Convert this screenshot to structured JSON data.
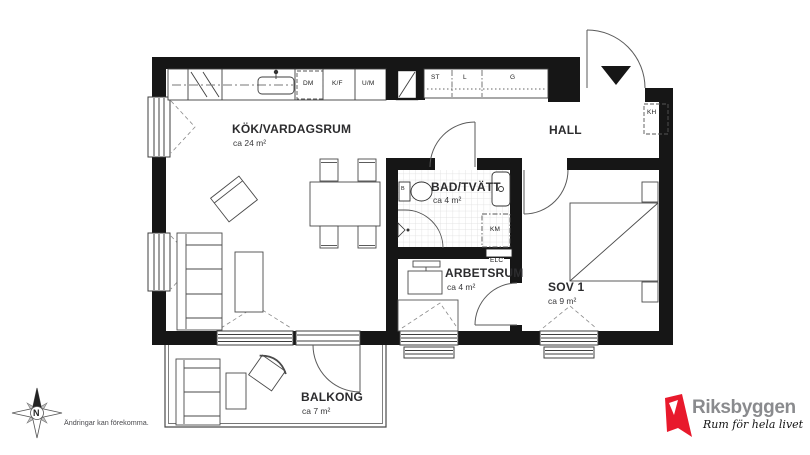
{
  "rooms": {
    "kitchen_living": {
      "name": "KÖK/VARDAGSRUM",
      "area": "ca 24 m²"
    },
    "hall": {
      "name": "HALL"
    },
    "bath": {
      "name": "BAD/TVÄTT",
      "area": "ca 4 m²"
    },
    "workroom": {
      "name": "ARBETSRUM",
      "area": "ca 4 m²"
    },
    "bedroom": {
      "name": "SOV 1",
      "area": "ca 9 m²"
    },
    "balcony": {
      "name": "BALKONG",
      "area": "ca 7 m²"
    }
  },
  "fixture_labels": {
    "dm": "DM",
    "kf": "K/F",
    "um": "U/M",
    "st": "ST",
    "l": "L",
    "g": "G",
    "kh": "KH",
    "km": "KM",
    "elc": "ELC",
    "b": "B"
  },
  "compass": {
    "north": "N"
  },
  "footer": {
    "disclaimer": "Ändringar kan förekomma."
  },
  "brand": {
    "name": "Riksbyggen",
    "tagline": "Rum för hela livet"
  },
  "icons": {
    "compass": "compass-rose-8-point",
    "entrance_marker": "filled-triangle-down",
    "shaft": "square-with-diagonal"
  },
  "colors": {
    "wall": "#161616",
    "line": "#3f3f3f",
    "tile": "#dcdcdc",
    "brand_red": "#e8192c",
    "brand_gray": "#8a8b8e"
  }
}
